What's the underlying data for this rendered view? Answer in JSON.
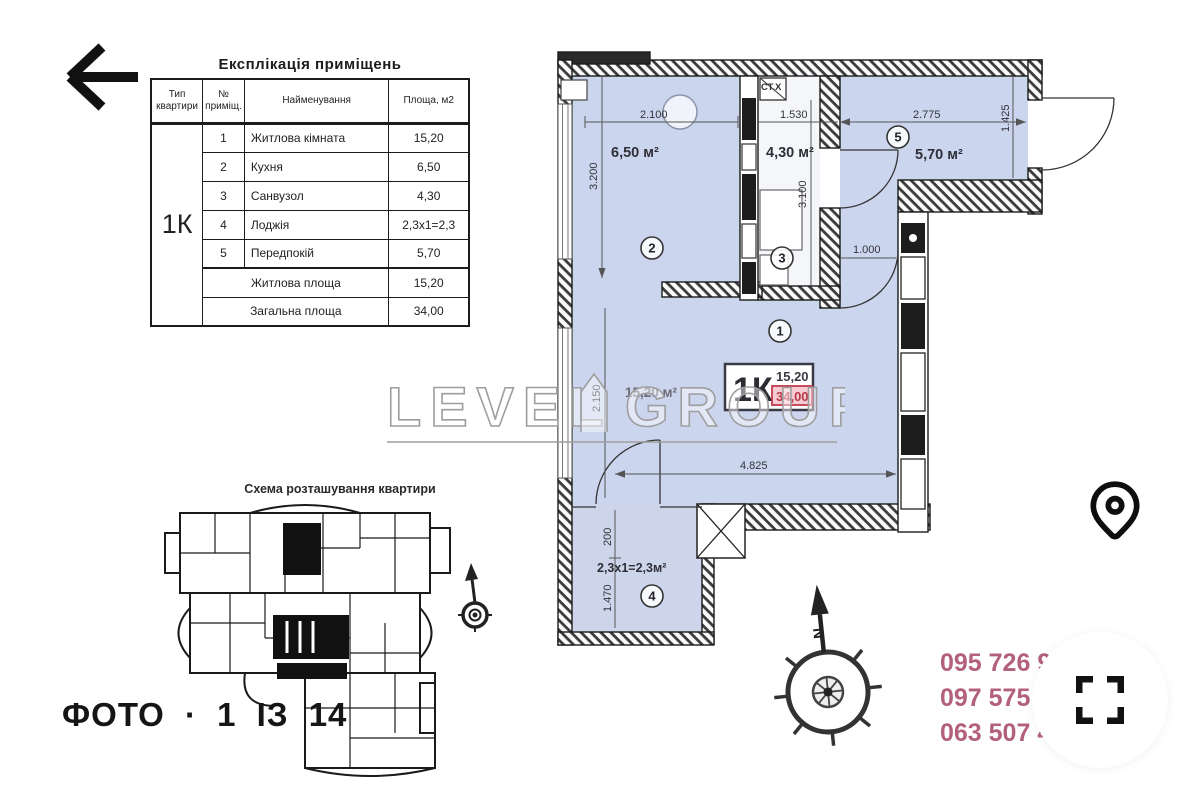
{
  "toolbar": {
    "back_icon": "back-arrow"
  },
  "table": {
    "title": "Експлікація приміщень",
    "col_type": "Тип квартири",
    "col_num": "№ приміщ.",
    "col_name": "Найменування",
    "col_area": "Площа, м2",
    "apartment_type": "1К",
    "rows": [
      {
        "num": "1",
        "name": "Житлова кімната",
        "area": "15,20"
      },
      {
        "num": "2",
        "name": "Кухня",
        "area": "6,50"
      },
      {
        "num": "3",
        "name": "Санвузол",
        "area": "4,30"
      },
      {
        "num": "4",
        "name": "Лоджія",
        "area": "2,3х1=2,3"
      },
      {
        "num": "5",
        "name": "Передпокій",
        "area": "5,70"
      }
    ],
    "summary_rows": [
      {
        "name": "Житлова площа",
        "area": "15,20"
      },
      {
        "name": "Загальна площа",
        "area": "34,00"
      }
    ]
  },
  "plan": {
    "rooms": [
      {
        "id": "1",
        "area_label": "15,20 м²"
      },
      {
        "id": "2",
        "area_label": "6,50 м²"
      },
      {
        "id": "3",
        "area_label": "4,30 м²"
      },
      {
        "id": "4",
        "area_label": "2,3х1=2,3м²"
      },
      {
        "id": "5",
        "area_label": "5,70 м²"
      }
    ],
    "shaft_label": "СТ.Х",
    "dims": {
      "d2100": "2.100",
      "d1530": "1.530",
      "d2775": "2.775",
      "d1425": "1.425",
      "d3200": "3.200",
      "d3100": "3.100",
      "d1000": "1.000",
      "d4825": "4.825",
      "d2150": "2.150",
      "d1470": "1.470",
      "d200": "200"
    },
    "stamp": {
      "type": "1К",
      "living": "15,20",
      "total": "34,00"
    },
    "north": "N"
  },
  "watermark": {
    "word1": "LEVEL",
    "word2": "GROUP"
  },
  "scheme": {
    "title": "Схема розташування квартири"
  },
  "footer": {
    "counter": "ФОТО · 1 ІЗ 14"
  },
  "contacts": {
    "phones": [
      "095 726 9",
      "097 575 4",
      "063 507 4"
    ],
    "phone_color": "#b2607c"
  },
  "colors": {
    "room_fill": "#ccd5ee",
    "bath_fill": "#f5f6fa",
    "accent_red": "#b9374a"
  },
  "icons": {
    "back": "back-arrow-icon",
    "pin": "location-pin-icon",
    "fullscreen": "fullscreen-brackets-icon",
    "compass": "compass-rose-icon"
  }
}
